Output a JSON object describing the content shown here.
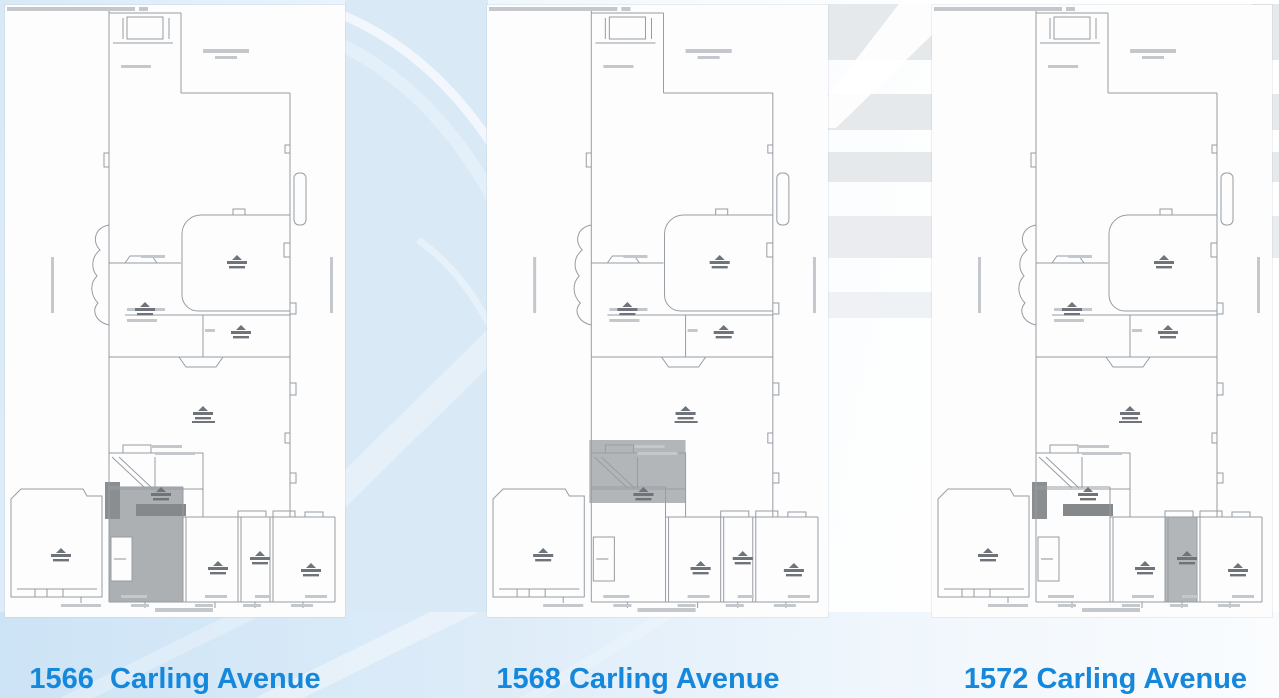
{
  "slide": {
    "panels": [
      {
        "id": "1566",
        "caption": "1566  Carling Avenue",
        "highlights": [
          [
            104,
            482,
            74,
            115,
            "#adb0b3"
          ],
          [
            106,
            532,
            21,
            44,
            "#fdfdfe"
          ],
          [
            100,
            477,
            15,
            37,
            "#8a8e91"
          ],
          [
            131,
            499,
            50,
            12,
            "#85898c"
          ]
        ]
      },
      {
        "id": "1568",
        "caption": "1568 Carling Avenue",
        "highlights": [
          [
            102,
            435,
            96,
            63,
            "#b3b6b9"
          ]
        ]
      },
      {
        "id": "1572",
        "caption": "1572 Carling Avenue",
        "highlights": [
          [
            100,
            477,
            15,
            37,
            "#8a8e91"
          ],
          [
            131,
            499,
            50,
            12,
            "#85898c"
          ],
          [
            233,
            512,
            32,
            85,
            "#b3b6b9"
          ]
        ]
      }
    ],
    "colors": {
      "caption_blue": "#1688db",
      "plan_line": "#979da3",
      "plan_mark": "#c4c8cd",
      "stamp_gray": "#6f747a",
      "highlight_gray": "#b3b6b9",
      "background_blue": "#d9e9f6",
      "stripe_gray": "#e6e9ec"
    }
  }
}
